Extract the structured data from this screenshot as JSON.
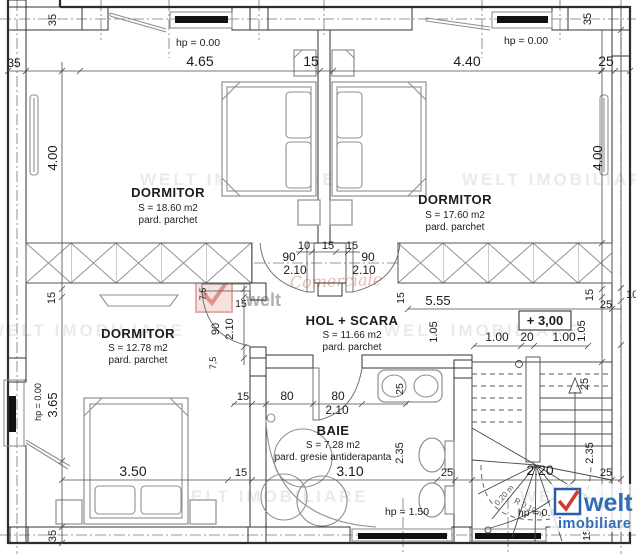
{
  "rooms": {
    "dormitor1": {
      "name": "DORMITOR",
      "area": "S = 18.60 m2",
      "floor": "pard. parchet"
    },
    "dormitor2": {
      "name": "DORMITOR",
      "area": "S = 17.60 m2",
      "floor": "pard. parchet"
    },
    "dormitor3": {
      "name": "DORMITOR",
      "area": "S = 12.78 m2",
      "floor": "pard. parchet"
    },
    "hol": {
      "name": "HOL + SCARA",
      "area": "S = 11.66 m2",
      "floor": "pard. parchet"
    },
    "baie": {
      "name": "BAIE",
      "area": "S = 7.28 m2",
      "floor": "pard. gresie antiderapanta"
    }
  },
  "levels": {
    "floor_level": "+ 3,00"
  },
  "windows": {
    "top_left": "hp = 0.00",
    "top_right": "hp = 0.00",
    "left": "hp = 0.00",
    "bath": "hp = 1.50",
    "stairs": "hp = 0.6"
  },
  "dims": {
    "top": [
      "35",
      "4.65",
      "15",
      "4.40",
      "25"
    ],
    "left": [
      "35",
      "4.00",
      "15",
      "3.65",
      "35"
    ],
    "right": [
      "35",
      "4.00",
      "15",
      "25",
      "10",
      "1.05",
      "25",
      "2.35",
      "25",
      "15"
    ],
    "hall_doors": [
      "10",
      "15",
      "15",
      "90",
      "2.10",
      "90",
      "2.10"
    ],
    "hall_right": [
      "5.55",
      "15",
      "1.05",
      "1.00",
      "20",
      "1.00"
    ],
    "door3": [
      "7,5",
      "90",
      "2.10",
      "7,5",
      "15"
    ],
    "bath": [
      "15",
      "80",
      "80",
      "2.10",
      "25",
      "2.35",
      "15",
      "3.10",
      "25"
    ],
    "bottom": [
      "3.50",
      "2.20"
    ]
  },
  "stair_notes": [
    "0,20 m",
    "R 0.19 m"
  ],
  "watermarks": {
    "row": "WELT IMOBILIARE",
    "script": "Comerciale"
  },
  "logo": {
    "brand": "welt",
    "sub": "imobiliare"
  }
}
